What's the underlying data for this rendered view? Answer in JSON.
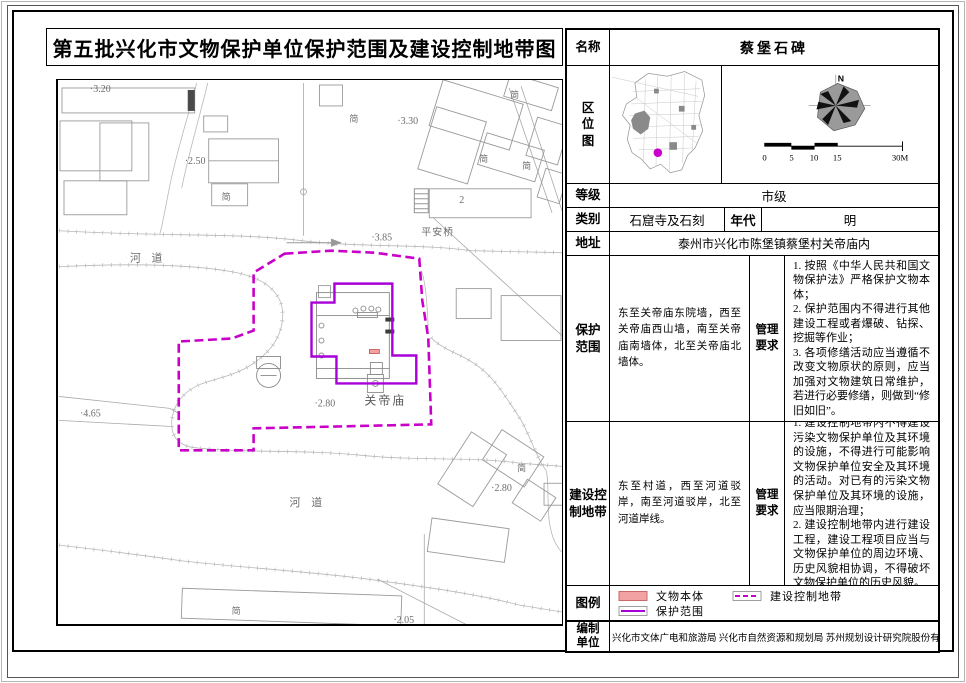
{
  "document": {
    "title": "第五批兴化市文物保护单位保护范围及建设控制地带图"
  },
  "table": {
    "name_label": "名称",
    "name_value": "蔡堡石碑",
    "location_label": "区\n位\n图",
    "compass_north": "N",
    "scale_ticks": [
      "0",
      "5",
      "10",
      "15",
      "30M"
    ],
    "grade_label": "等级",
    "grade_value": "市级",
    "category_label": "类别",
    "category_value": "石窟寺及石刻",
    "era_label": "年代",
    "era_value": "明",
    "address_label": "地址",
    "address_value": "泰州市兴化市陈堡镇蔡堡村关帝庙内",
    "protection_label": "保护\n范围",
    "protection_value": "东至关帝庙东院墙，西至关帝庙西山墙，南至关帝庙南墙体，北至关帝庙北墙体。",
    "mgmt_label": "管理\n要求",
    "protection_mgmt": [
      "1. 按照《中华人民共和国文物保护法》严格保护文物本体；",
      "2. 保护范围内不得进行其他建设工程或者爆破、钻探、挖掘等作业；",
      "3. 各项修缮活动应当遵循不改变文物原状的原则，应当加强对文物建筑日常维护，若进行必要修缮，则做到“修旧如旧”。"
    ],
    "control_label": "建设控\n制地带",
    "control_value": "东至村道，西至河道驳岸，南至河道驳岸，北至河道岸线。",
    "control_mgmt": [
      "1. 建设控制地带内不得建设污染文物保护单位及其环境的设施，不得进行可能影响文物保护单位安全及其环境的活动。对已有的污染文物保护单位及其环境的设施，应当限期治理；",
      "2. 建设控制地带内进行建设工程，建设工程项目应当与文物保护单位的周边环境、历史风貌相协调，不得破坏文物保护单位的历史风貌。"
    ],
    "legend_label": "图例",
    "legend_item_heritage": "文物本体",
    "legend_item_protection": "保护范围",
    "legend_item_control": "建设控制地带",
    "compiler_label": "编制\n单位",
    "compiler_value": "兴化市文体广电和旅游局  兴化市自然资源和规划局  苏州规划设计研究院股份有限公司"
  },
  "map": {
    "river_label": "河  道",
    "temple_label": "关帝庙",
    "bridge_label": "平安桥",
    "building_number": "2",
    "shed_label": "简",
    "elevations": {
      "e320": "·3.20",
      "e250": "·2.50",
      "e330": "·3.30",
      "e385": "·3.85",
      "e465": "·4.65",
      "e280a": "·2.80",
      "e280b": "·2.80",
      "e205": "·2.05"
    }
  },
  "colors": {
    "control_boundary": "#c800c8",
    "protection_boundary": "#a800d8",
    "heritage_fill": "#f2a2a2",
    "location_dot": "#cc00cc"
  }
}
